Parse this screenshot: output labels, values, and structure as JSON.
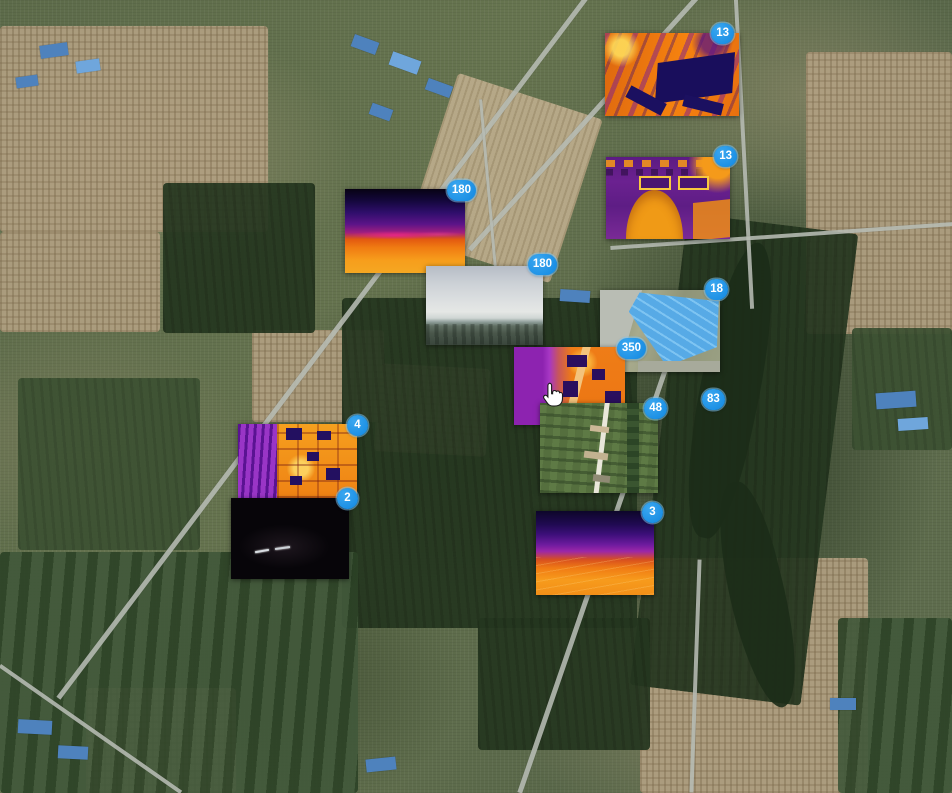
{
  "app": {
    "view": "satellite-map-media-clusters"
  },
  "colors": {
    "badge_background": "#1e96e8",
    "badge_text": "#ffffff",
    "badge_ring": "#82cdff",
    "map_base_green": "#62704f",
    "map_village_tan": "#b3a183",
    "map_field_dark": "#24361f",
    "map_road_gray": "#b7bcb4",
    "roof_blue": "#4e82bd"
  },
  "cursor": {
    "icon": "hand-pointer"
  },
  "markers": [
    {
      "count": "13",
      "kind": "thermal-orthomosaic-warehouses"
    },
    {
      "count": "13",
      "kind": "thermal-orthomosaic-gate-building"
    },
    {
      "count": "18",
      "kind": "aerial-blue-roof-warehouse"
    },
    {
      "count": "180",
      "kind": "thermal-horizon-view"
    },
    {
      "count": "180",
      "kind": "hazy-horizon-photo"
    },
    {
      "count": "350",
      "kind": "thermal-orthomosaic-village"
    },
    {
      "count": "48",
      "kind": "aerial-farm-fields-road"
    },
    {
      "count": "83",
      "kind": "cluster-only"
    },
    {
      "count": "4",
      "kind": "thermal-orthomosaic-solar-site"
    },
    {
      "count": "2",
      "kind": "night-low-light-photo"
    },
    {
      "count": "3",
      "kind": "thermal-horizon-view-purple"
    }
  ]
}
